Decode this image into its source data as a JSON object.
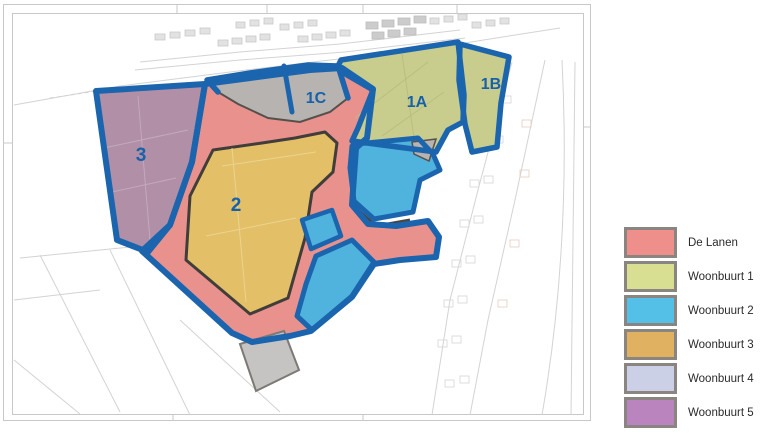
{
  "legend": {
    "items": [
      {
        "label": "De Lanen",
        "color": "#ef8f8b"
      },
      {
        "label": "Woonbuurt 1",
        "color": "#d8de92"
      },
      {
        "label": "Woonbuurt 2",
        "color": "#54c0e8"
      },
      {
        "label": "Woonbuurt 3",
        "color": "#dfb160"
      },
      {
        "label": "Woonbuurt 4",
        "color": "#cbd0e6"
      },
      {
        "label": "Woonbuurt 5",
        "color": "#ba84bf"
      }
    ]
  },
  "map": {
    "zone_labels": {
      "zone3": "3",
      "zone2": "2",
      "zone1c": "1C",
      "zone1a": "1A",
      "zone1b": "1B"
    },
    "label_color": "#1761a8",
    "zone_fill_colors": {
      "de_lanen": "#e9928d",
      "woonbuurt1_green": "#c8cd8e",
      "woonbuurt2_blue": "#4fb3dd",
      "woonbuurt3_yellow": "#e3c068",
      "woonbuurt5_purple": "#b18fa6",
      "gray_area": "#b6b3b1",
      "gray_parcel": "#c6c4c2",
      "boundary_blue": "#1b64ae"
    }
  }
}
